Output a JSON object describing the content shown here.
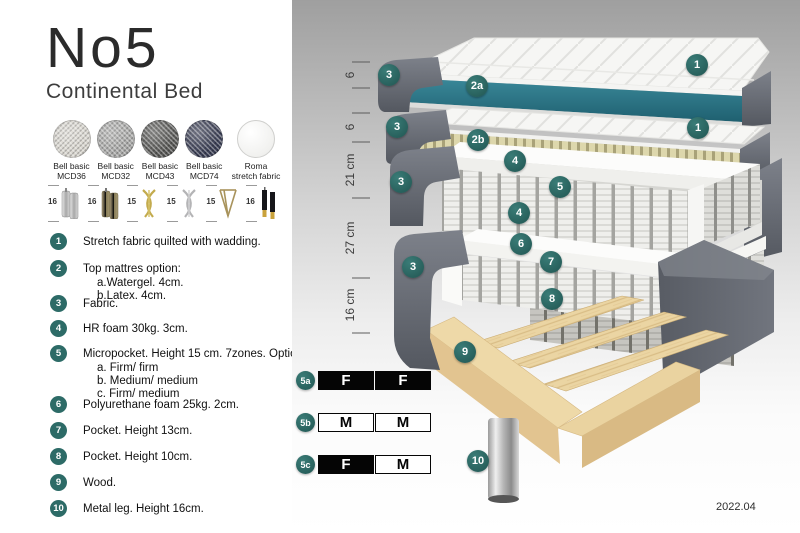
{
  "brand": {
    "model": "No5",
    "product": "Continental Bed"
  },
  "fabrics": [
    {
      "line1": "Bell basic",
      "line2": "MCD36",
      "color": "#d9d6cf"
    },
    {
      "line1": "Bell basic",
      "line2": "MCD32",
      "color": "#a8a8a6"
    },
    {
      "line1": "Bell basic",
      "line2": "MCD43",
      "color": "#575755"
    },
    {
      "line1": "Bell basic",
      "line2": "MCD74",
      "color": "#3a3e54"
    },
    {
      "line1": "Roma",
      "line2": "stretch fabric",
      "color": "#f5f5f3"
    }
  ],
  "legs": [
    {
      "height": "16",
      "type": "cylinder-silver"
    },
    {
      "height": "16",
      "type": "cylinder-bronze"
    },
    {
      "height": "15",
      "type": "twist-gold"
    },
    {
      "height": "15",
      "type": "twist-silver"
    },
    {
      "height": "15",
      "type": "hairpin-gold"
    },
    {
      "height": "16",
      "type": "taper-black-gold"
    }
  ],
  "spec": {
    "items": [
      {
        "num": "1",
        "text": "Stretch fabric quilted with wadding."
      },
      {
        "num": "2",
        "text": "Top mattres option:",
        "subs": [
          "a.Watergel. 4cm.",
          "b.Latex. 4cm."
        ]
      },
      {
        "num": "3",
        "text": "Fabric."
      },
      {
        "num": "4",
        "text": "HR foam 30kg. 3cm."
      },
      {
        "num": "5",
        "text": "Micropocket. Height 15 cm. 7zones. Option:",
        "subs": [
          "a. Firm/ firm",
          "b. Medium/ medium",
          "c. Firm/ medium"
        ]
      },
      {
        "num": "6",
        "text": "Polyurethane foam 25kg. 2cm."
      },
      {
        "num": "7",
        "text": "Pocket. Height 13cm."
      },
      {
        "num": "8",
        "text": "Pocket. Height 10cm."
      },
      {
        "num": "9",
        "text": "Wood."
      },
      {
        "num": "10",
        "text": "Metal leg. Height 16cm."
      }
    ]
  },
  "diagram": {
    "badges": [
      "3",
      "2a",
      "1",
      "3",
      "2b",
      "1",
      "4",
      "5",
      "3",
      "4",
      "6",
      "7",
      "3",
      "8",
      "9",
      "10"
    ],
    "measurements": [
      "6",
      "6",
      "21 cm",
      "27 cm",
      "16 cm"
    ]
  },
  "firmness": {
    "rows": [
      {
        "id": "5a",
        "cells": [
          "F",
          "F"
        ],
        "variants": [
          "firm",
          "firm"
        ]
      },
      {
        "id": "5b",
        "cells": [
          "M",
          "M"
        ],
        "variants": [
          "medium",
          "medium"
        ]
      },
      {
        "id": "5c",
        "cells": [
          "F",
          "M"
        ],
        "variants": [
          "firm",
          "medium"
        ]
      }
    ]
  },
  "footer": {
    "version": "2022.04"
  },
  "colors": {
    "badge_teal": "#2d6b67",
    "layer_teal": "#2e7a8e",
    "dark_fabric": "#63666e",
    "latex": "#ded8ae",
    "wood": "#ecd6a4"
  }
}
